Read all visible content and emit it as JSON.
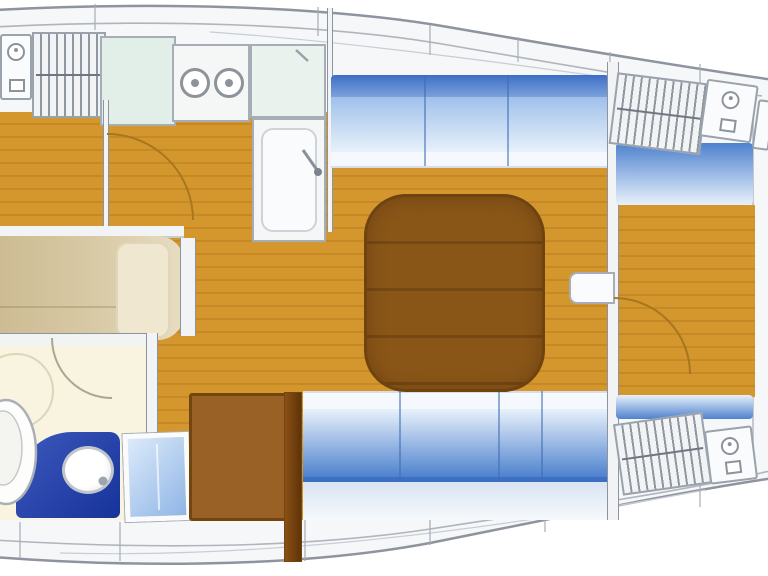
{
  "diagram": {
    "type": "yacht interior floor plan (top view, bow to the right)",
    "rooms": {
      "galley": {
        "name": "galley",
        "features": [
          "storage-locker",
          "basin-cabinet",
          "counter",
          "two-burner-stove",
          "sink-top",
          "sink-unit"
        ]
      },
      "aft_cabin": {
        "name": "aft cabin",
        "features": [
          "wood-floor",
          "door-swing",
          "double-berth",
          "pillow"
        ]
      },
      "head": {
        "name": "head / WC",
        "features": [
          "door-swing",
          "toilet",
          "vanity-with-round-sink",
          "shower-circle"
        ]
      },
      "saloon": {
        "name": "saloon",
        "features": [
          "port-settee-3-cushions",
          "starboard-settee-4-cushions",
          "dining-table",
          "companionway-steps",
          "wood-floor"
        ]
      },
      "forward_cabin": {
        "name": "forward cabin",
        "features": [
          "berth-cushion-top",
          "berth-cushion-bottom",
          "storage-lockers",
          "basin-cabinets",
          "door-swing",
          "wood-floor"
        ]
      }
    },
    "cushion_sections": {
      "port_settee": 3,
      "starboard_settee": 4
    },
    "stove_burners": 2
  },
  "colors": {
    "wood": "#D4972E",
    "woodStripe": "rgba(170,110,20,0.35)",
    "arc": "#A8761F",
    "table": "#8A5618",
    "tableBorder": "#6E4310",
    "tableLine": "rgba(70,40,5,0.30)",
    "cushDeep": "#4E82CE",
    "cushBar": "#3D6FC4",
    "cushBarLight": "#7CA2DC",
    "cushMid": "#9FC0EA",
    "cushLight": "#E8F1FB",
    "cushEdge": "#F5F8FD",
    "cushDivider": "#3E6DB4",
    "berth": "#D9CBA7",
    "berthDark": "#CDBC93",
    "berthLight": "#E7DDC2",
    "pillow": "#EFE7CF",
    "pillowEdge": "#E0D6B8",
    "headFloor": "#F8F4E0",
    "vanity1": "#3E59BC",
    "vanity2": "#16339B",
    "chart1": "#DCEAFA",
    "chart2": "#8FB5E6",
    "steps": "#9A6126",
    "stepsBorder": "#74460F",
    "plank1": "#8A5016",
    "plank2": "#5E3408",
    "deck": "#F5F7F9",
    "hullLine": "#8E949E",
    "innerLine": "#AFB5BD",
    "faintLine": "#C8CDD4",
    "wall": "#F1F3F5",
    "lockerBg": "#F1F3F5",
    "lockerBorder": "#9AA2AC",
    "lockerHatch": "#8F97A1",
    "lockerMid": "#6F7680",
    "boxBg": "#FAFBFC",
    "boxBorder": "#A7ADB6",
    "counter": "#E2EFE9",
    "stoveBg": "#F4F7F6",
    "sinkTopBg": "#EAF2EE",
    "iconGray": "#8D939B",
    "faint": "#DAD6BA",
    "toiletRim": "#AAB0B8"
  }
}
